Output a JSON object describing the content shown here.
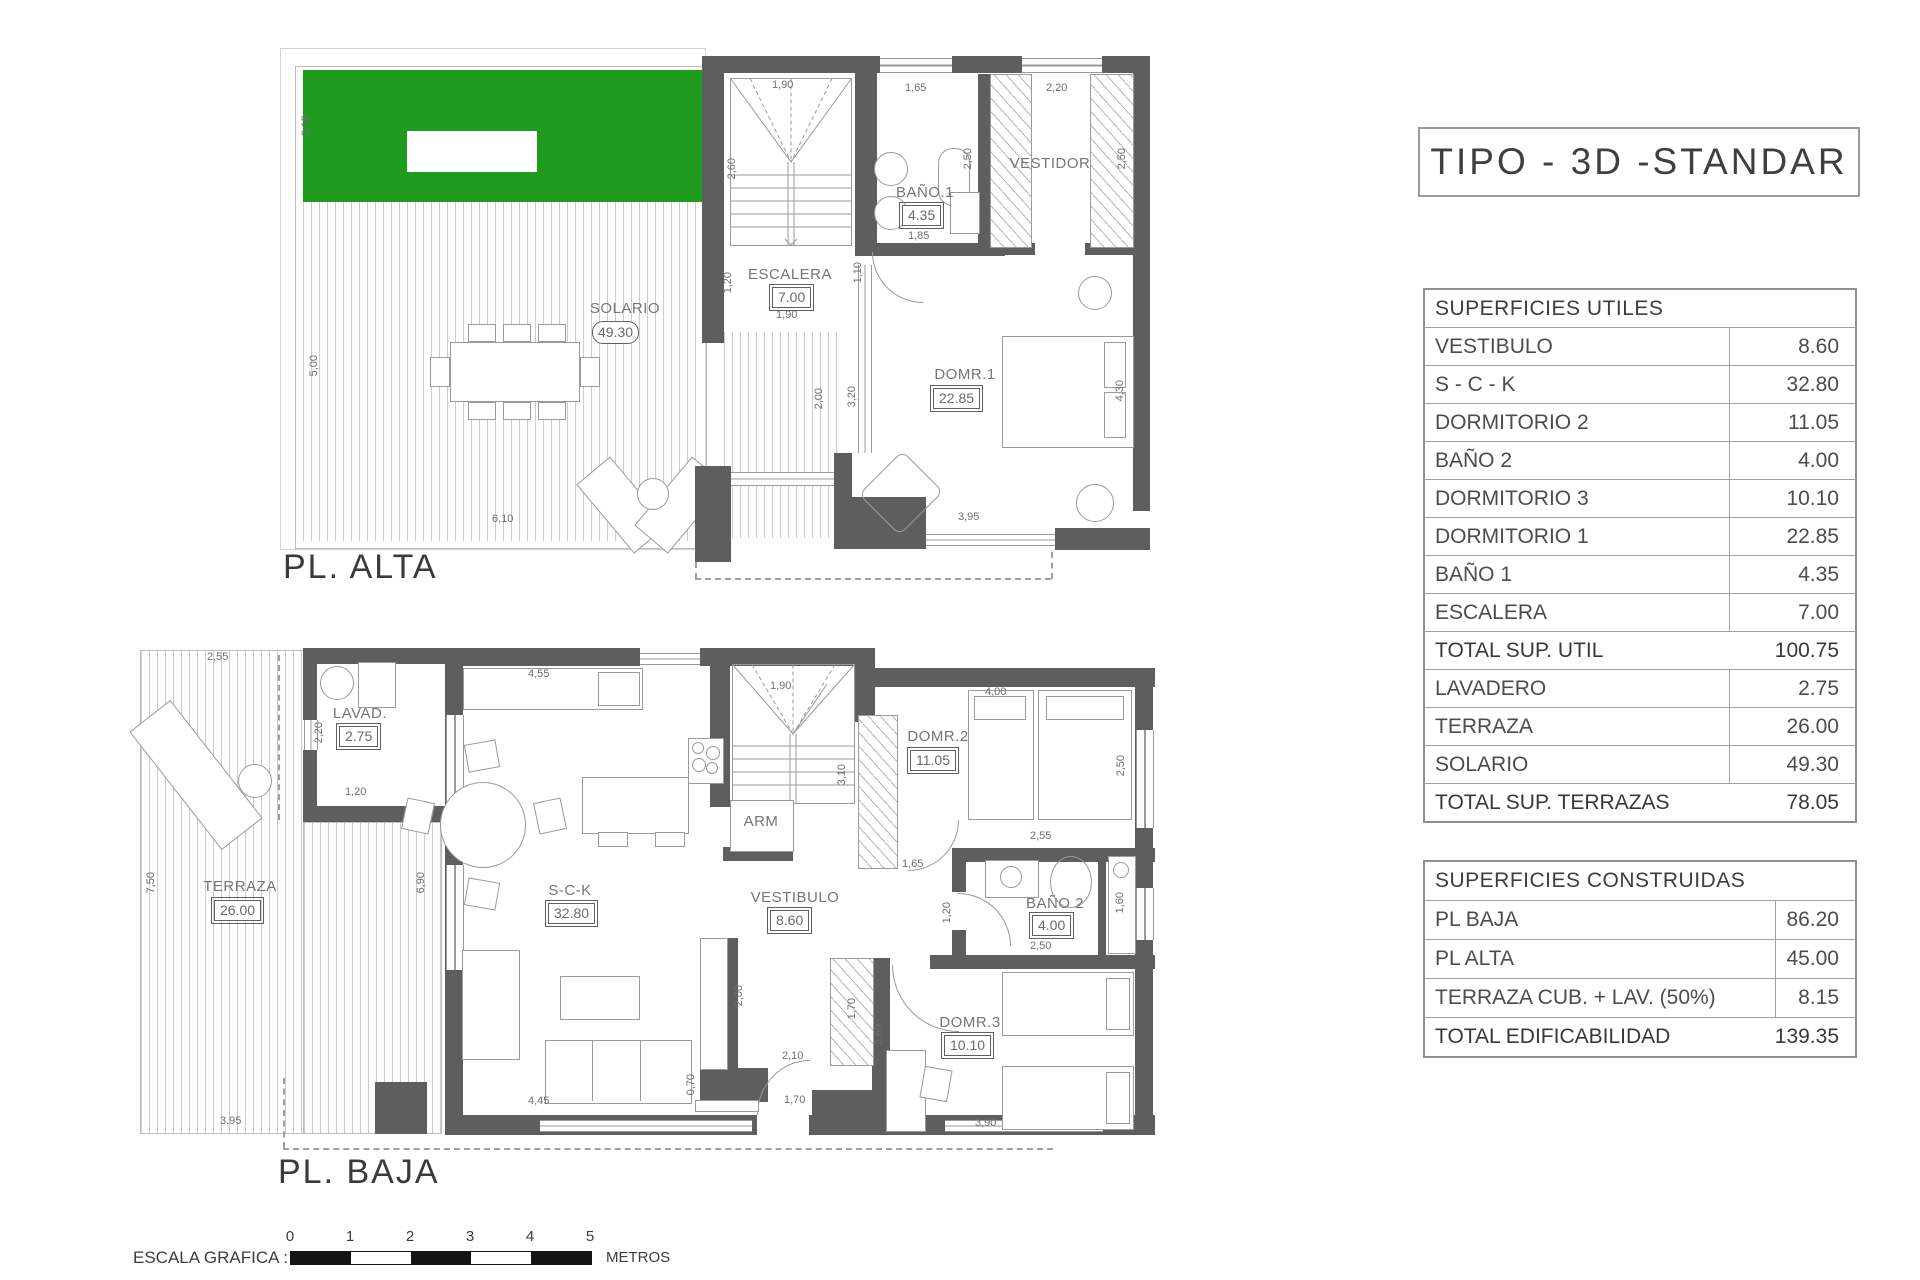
{
  "title": "TIPO - 3D -STANDAR",
  "colors": {
    "grass": "#1f9b1f",
    "wall": "#5e5e5e",
    "deck_stripe": "#cccccc",
    "text_dark": "#3c3c3c",
    "text_dim": "#6e6e6e"
  },
  "plans": {
    "alta": {
      "name": "PL. ALTA",
      "rooms": {
        "solario": {
          "label": "SOLARIO",
          "value": "49.30"
        },
        "escalera": {
          "label": "ESCALERA",
          "value": "7.00"
        },
        "bano1": {
          "label": "BAÑO.1",
          "value": "4.35"
        },
        "vestidor": {
          "label": "VESTIDOR"
        },
        "dorm1": {
          "label": "DOMR.1",
          "value": "22.85"
        }
      },
      "dims": {
        "g_h": "2,15",
        "d_h": "5,00",
        "d_w": "6,10",
        "st_top": "1,90",
        "st_h": "2,60",
        "st_low": "1,20",
        "st_bot": "1,90",
        "win1": "1,65",
        "win2": "2,20",
        "tub": "2,50",
        "ves_h": "2,50",
        "ban_w": "1,85",
        "door": "1,10",
        "d1_a": "2,00",
        "d1_b": "3,20",
        "d1_h": "4,30",
        "d1_w": "3,95"
      }
    },
    "baja": {
      "name": "PL. BAJA",
      "rooms": {
        "terraza": {
          "label": "TERRAZA",
          "value": "26.00"
        },
        "lavadero": {
          "label": "LAVAD.",
          "value": "2.75"
        },
        "sck": {
          "label": "S-C-K",
          "value": "32.80"
        },
        "vestibulo": {
          "label": "VESTIBULO",
          "value": "8.60"
        },
        "arm": {
          "label": "ARM"
        },
        "dorm2": {
          "label": "DOMR.2",
          "value": "11.05"
        },
        "bano2": {
          "label": "BAÑO 2",
          "value": "4.00"
        },
        "dorm3": {
          "label": "DOMR.3",
          "value": "10.10"
        }
      },
      "dims": {
        "t_top": "2,55",
        "t_h": "7,50",
        "t_bot": "3,95",
        "lv_h": "2,20",
        "lv_w": "1,20",
        "k_w": "4,55",
        "w_h": "6,90",
        "st_w": "1,90",
        "st_h2": "3,10",
        "d2_door": "1,65",
        "d2_w": "4,00",
        "d2_h": "2,50",
        "b2_top": "2,55",
        "b2_w": "2,50",
        "b2_door": "1,20",
        "b2_h": "1,60",
        "v_a": "2,00",
        "v_b": "2,10",
        "v_c": "1,70",
        "cl_h": "1,70",
        "s_small": "0,70",
        "s_w": "4,45",
        "d3_h": "2,60",
        "d3_w": "3,90"
      }
    }
  },
  "tables": {
    "utiles": {
      "header": "SUPERFICIES UTILES",
      "rows": [
        {
          "label": "VESTIBULO",
          "value": "8.60"
        },
        {
          "label": "S - C - K",
          "value": "32.80"
        },
        {
          "label": "DORMITORIO 2",
          "value": "11.05"
        },
        {
          "label": "BAÑO 2",
          "value": "4.00"
        },
        {
          "label": "DORMITORIO 3",
          "value": "10.10"
        },
        {
          "label": "DORMITORIO 1",
          "value": "22.85"
        },
        {
          "label": "BAÑO 1",
          "value": "4.35"
        },
        {
          "label": "ESCALERA",
          "value": "7.00"
        },
        {
          "label": "TOTAL SUP. UTIL",
          "value": "100.75",
          "total": true
        },
        {
          "label": "LAVADERO",
          "value": "2.75"
        },
        {
          "label": "TERRAZA",
          "value": "26.00"
        },
        {
          "label": "SOLARIO",
          "value": "49.30"
        },
        {
          "label": "TOTAL SUP. TERRAZAS",
          "value": "78.05",
          "total": true
        }
      ]
    },
    "construidas": {
      "header": "SUPERFICIES CONSTRUIDAS",
      "rows": [
        {
          "label": "PL BAJA",
          "value": "86.20"
        },
        {
          "label": "PL ALTA",
          "value": "45.00"
        },
        {
          "label": "TERRAZA CUB. + LAV. (50%)",
          "value": "8.15"
        },
        {
          "label": "TOTAL EDIFICABILIDAD",
          "value": "139.35",
          "total": true
        }
      ]
    }
  },
  "scale": {
    "label": "ESCALA GRAFICA :",
    "ticks": [
      "0",
      "1",
      "2",
      "3",
      "4",
      "5"
    ],
    "unit": "METROS"
  }
}
